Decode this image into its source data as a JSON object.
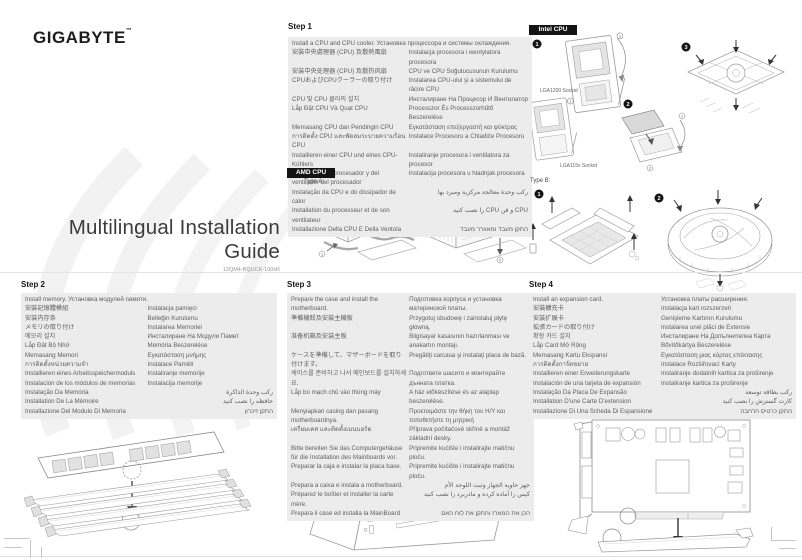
{
  "logo": {
    "text": "GIGABYTE",
    "tm": "™"
  },
  "title": {
    "text": "Multilingual Installation Guide",
    "part_number": "12QM4-BQUCK-100xR"
  },
  "tags": {
    "intel": "Intel CPU",
    "amd": "AMD CPU"
  },
  "labels": {
    "type_a": "Type A:",
    "type_b": "Type B:",
    "lga1200": "LGA1200 Socket",
    "lga115x": "LGA115x Socket"
  },
  "badges": {
    "n1": "1",
    "n2": "2",
    "n3": "3"
  },
  "colors": {
    "tag_bg": "#141414",
    "box_bg": "#ececec",
    "body_text": "#5f5f5f",
    "accent": "#111111"
  },
  "sections": {
    "step1": {
      "heading": "Step 1",
      "rows": [
        {
          "l": "Install a CPU and CPU cooler. Установка процессора и системы охлаждения.",
          "full": true
        },
        {
          "l": "安裝中央處理器 (CPU) 及散熱風扇",
          "r": "Instalacja procesora i wentylatora procesora"
        },
        {
          "l": "安装中央处理器 (CPU) 及散热风扇",
          "r": "CPU ve CPU Soğutucusunun Kurulumu"
        },
        {
          "l": "CPUおよびCPUクーラーの取り付け",
          "r": "Instalarea CPU-ului şi a sistemului de răcire CPU"
        },
        {
          "l": "CPU 및 CPU 쿨러의 설치",
          "r": "Инсталиране На Процесор И Вентилатор"
        },
        {
          "l": "Lắp Đặt CPU Và Quạt CPU",
          "r": "Processzor És Processzorhűtő Beszerelése"
        },
        {
          "l": "Memasang CPU dan Pendingin CPU",
          "r": "Εγκατάσταση επεξεργαστή και ψύκτρας"
        },
        {
          "l": "การติดตั้ง CPU และพัดลมระบายความร้อน CPU",
          "r": "Instalace Procesoru a Chladiče Procesoru"
        },
        {
          "l": "Installieren einer CPU und eines CPU-Kühlers",
          "r": "Instaliranje procesora i ventilatora za procesor"
        },
        {
          "l": "Instalación del procesador y del ventilador del procesador",
          "r": "Instalacija procesora u hladnjak procesora"
        },
        {
          "l": "Instalação da CPU e do dissipador de calor",
          "r": "ركب وحدة معالجة مركزية ومبرد بها",
          "rtl": true
        },
        {
          "l": "Installation du processeur et de son ventilateur",
          "r": "CPU و فن CPU را نصب كنيد",
          "rtl": true
        },
        {
          "l": "Installazione Della CPU E Della Ventola",
          "r": "התקן מעבד ומאוורר מעבד",
          "rtl": true
        }
      ]
    },
    "step2": {
      "heading": "Step 2",
      "rows": [
        {
          "l": "Install memory. Установка модулей памяти.",
          "full": true
        },
        {
          "l": "安裝記憶體模組",
          "r": "Instalacja pamięci"
        },
        {
          "l": "安装内存条",
          "r": "Belleğin Kurulumu"
        },
        {
          "l": "メモリの取り付け",
          "r": "Instalarea Memoriei"
        },
        {
          "l": "메모리 설치",
          "r": "Инсталиране На Модули Памет"
        },
        {
          "l": "Lắp Đặt Bộ Nhớ",
          "r": "Memória Beszerelése"
        },
        {
          "l": "Memasang Memori",
          "r": "Εγκατάσταση μνήμης"
        },
        {
          "l": "การติดตั้งหน่วยความจำ",
          "r": "Instalace Pamětí"
        },
        {
          "l": "Installieren eines Arbeitsspeichermoduls",
          "r": "Instaliranje memorije"
        },
        {
          "l": "Instalación de los módulos de memorias",
          "r": "Instalacija memorije"
        },
        {
          "l": "Instalação Da Memória",
          "r": "ركب وحدة الذاكرة",
          "rtl": true
        },
        {
          "l": "Installation De La Mémoire",
          "r": "حافظه را نصب كنيد",
          "rtl": true
        },
        {
          "l": "Installazione Del Modulo Di Memoria",
          "r": "התקן זיכרון",
          "rtl": true
        }
      ]
    },
    "step3": {
      "heading": "Step 3",
      "rows": [
        {
          "l": "Prepare the case and install the motherboard.",
          "r": "Подготовка корпуса и установка материнской платы."
        },
        {
          "l": "準備機殼及安裝主機板",
          "r": "Przygotuj obudowę i zainstaluj płytę główną."
        },
        {
          "l": "准备机箱及安装主板",
          "r": "Bilgisayar kasasının hazırlanması ve anakartın montajı."
        },
        {
          "l": "ケースを準備して、マザーボードを取り付けます。",
          "r": "Pregătiţi carcasa şi instalaţi placa de bază."
        },
        {
          "l": "케이스를 준비하고 나서 메인보드를 설치하세요.",
          "r": "Подгответе шасито и монтирайте дънната платка."
        },
        {
          "l": "Lắp bo mạch chủ vào thùng máy",
          "r": "A ház előkészítése és az alaplap beszerelése."
        },
        {
          "l": "Menyiapkan casing dan pasang motherboardnya.",
          "r": "Προετοιμάστε την θήκη του Η/Υ και τοποθετήστε τη μητρική"
        },
        {
          "l": "เตรียมเคส และติดตั้งเมนบอร์ด",
          "r": "Příprava počítačové skříně a montáž základní desky."
        },
        {
          "l": "Bitte bereiten Sie das Computergehäuse für die Installation des Mainboards vor.",
          "r": "Pripremite kućište i instalirajte matičnu ploču."
        },
        {
          "l": "Preparar la caja e instalar la placa base.",
          "r": "Pripremite kućište i instalirajte matičnu ploču."
        },
        {
          "l": "Prepara a caixa e instala a motherboard.",
          "r": "جهز حاوية الجهاز وثبت اللوحة الأم",
          "rtl": true
        },
        {
          "l": "Préparez le boîtier et installer la carte mère.",
          "r": "كيس را آماده كرده و مادربرد را نصب كنيد",
          "rtl": true
        },
        {
          "l": "Prepara il case ed installa la MainBoard",
          "r": "הכן את המארז והתקן את לוח האם",
          "rtl": true
        }
      ]
    },
    "step4": {
      "heading": "Step 4",
      "rows": [
        {
          "l": "Install an expansion card.",
          "r": "Установка платы расширения."
        },
        {
          "l": "安裝擴充卡",
          "r": "Instalacja kart rozszerzeń"
        },
        {
          "l": "安装扩展卡",
          "r": "Genişleme Kartının Kurulumu"
        },
        {
          "l": "拡張カードの取り付け",
          "r": "Instalarea unei plăci de Extensie"
        },
        {
          "l": "확장 카드 설치",
          "r": "Инсталиране На Допълнителна Карта"
        },
        {
          "l": "Lắp Card Mở Rộng",
          "r": "Bővítőkártya Beszerelése"
        },
        {
          "l": "Memasang Kartu Ekspansi",
          "r": "Εγκατάσταση μιας κάρτας επέκτασης"
        },
        {
          "l": "การติดตั้งการ์ดขยาย",
          "r": "Instalace Rozšiřovací Karty"
        },
        {
          "l": "Installieren einer Erweiterungskarte",
          "r": "Instaliranje dodatnih kartica za proširenje"
        },
        {
          "l": "Instalación de una tarjeta de expansión",
          "r": "Instaliranje kartica za proširenje"
        },
        {
          "l": "Instalação Da Placa De Expansão",
          "r": "ركب بطاقة توسعة",
          "rtl": true
        },
        {
          "l": "Installation D'une Carte D'extension",
          "r": "كارت گسترش را نصب كنيد",
          "rtl": true
        },
        {
          "l": "Installazione Di Una Scheda Di Espansione",
          "r": "התקן כרטיס הרחבה",
          "rtl": true
        }
      ]
    }
  }
}
